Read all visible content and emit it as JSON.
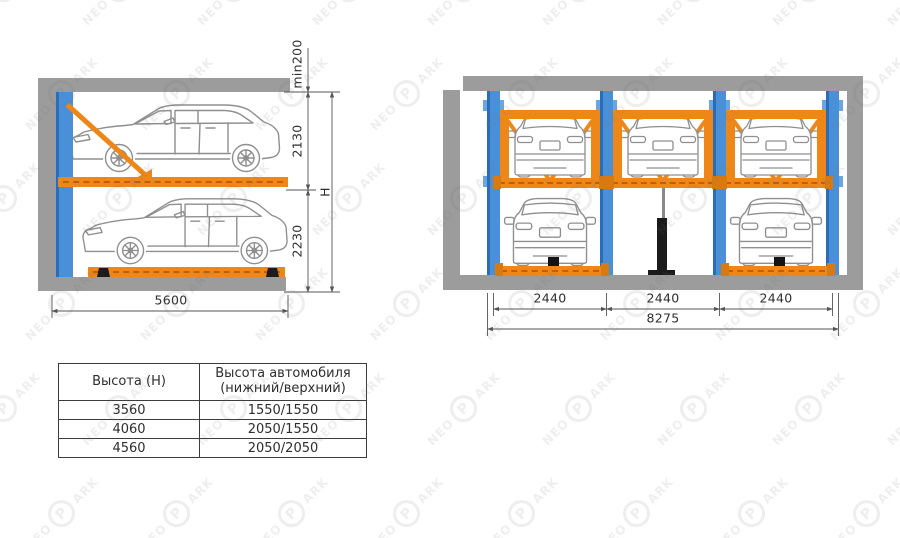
{
  "watermark": {
    "prefix": "NEO",
    "badge": "P",
    "suffix": "ARK"
  },
  "colors": {
    "orange": "#ef8718",
    "orange_dark": "#d97a10",
    "blue": "#4a90d9",
    "blue_dark": "#2a6db5",
    "blue_light": "#6aa7e2",
    "structure_gray": "#9c9c9c",
    "dim_line": "#555555",
    "ink": "#2e2e2e"
  },
  "side_view": {
    "dim_min_gap": "min200",
    "dim_upper_level": "2130",
    "dim_lower_level": "2230",
    "dim_total_height": "H",
    "dim_platform_length": "5600"
  },
  "front_view": {
    "dim_bays": [
      "2440",
      "2440",
      "2440"
    ],
    "dim_total_width": "8275"
  },
  "spec_table": {
    "col1_header": "Высота  (H)",
    "col2_header_line1": "Высота автомобиля",
    "col2_header_line2": "(нижний/верхний)",
    "rows": [
      {
        "height": "3560",
        "cars": "1550/1550"
      },
      {
        "height": "4060",
        "cars": "2050/1550"
      },
      {
        "height": "4560",
        "cars": "2050/2050"
      }
    ]
  }
}
